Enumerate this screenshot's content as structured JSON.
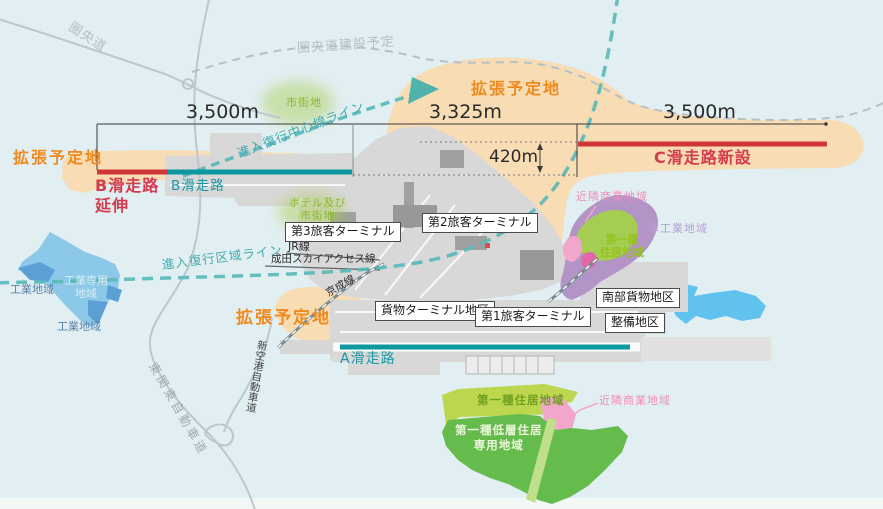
{
  "roads": {
    "kenodo": "圏央道",
    "kenodo_planned": "圏央道建設予定",
    "shin_kuko": "新空港自動車道",
    "higashi_kanto": "東関東自動車道"
  },
  "railways": {
    "jr": "JR線",
    "sky_access": "成田スカイアクセス線",
    "keisei": "京成線"
  },
  "runways": {
    "a": "A滑走路",
    "b": "B滑走路",
    "b_ext_l1": "B滑走路",
    "b_ext_l2": "延伸",
    "c_new": "C滑走路新設"
  },
  "approach": {
    "centerline": "進入復行中心線ライン",
    "zone": "進入復行区域ライン"
  },
  "expansion": {
    "label": "拡張予定地"
  },
  "measurements": {
    "b_total": "3,500m",
    "mid": "3,325m",
    "offset": "420m",
    "c_total": "3,500m"
  },
  "facilities": {
    "terminal3": "第3旅客ターミナル",
    "terminal2": "第2旅客ターミナル",
    "terminal1": "第1旅客ターミナル",
    "cargo_area": "貨物ターミナル地区",
    "south_cargo": "南部貨物地区",
    "maintenance": "整備地区"
  },
  "zones": {
    "urban": "市街地",
    "hotel_urban_l1": "ホテル及び",
    "hotel_urban_l2": "市街地",
    "industrial": "工業地域",
    "industrial_excl_l1": "工業専用",
    "industrial_excl_l2": "地域",
    "neighborhood_commercial": "近隣商業地域",
    "semi_industrial": "準工業地域",
    "res1_l1": "第一種",
    "res1_l2": "住居地域",
    "res1": "第一種住居地域",
    "low_rise_l1": "第一種低層住居",
    "low_rise_l2": "専用地域"
  },
  "colors": {
    "water": "#e1eff2",
    "expansion_area": "#f8dcb4",
    "expansion_text": "#ef8a1f",
    "runway_new_red": "#cf3636",
    "runway_existing_teal": "#0d98a0",
    "approach_dash_teal": "#56b8b8",
    "airport_gray": "#d8d8d8",
    "road_gray": "#bcc7cc",
    "industrial_blue": "#8cc8e8",
    "industrial_blue_dark": "#5b9fd4",
    "lake_blue": "#62c2ee",
    "residential_band_green": "#bcd74f",
    "residential_green": "#66bb4d",
    "commercial_pink": "#f2a6cc",
    "semi_industrial_purple": "#b394c7"
  }
}
